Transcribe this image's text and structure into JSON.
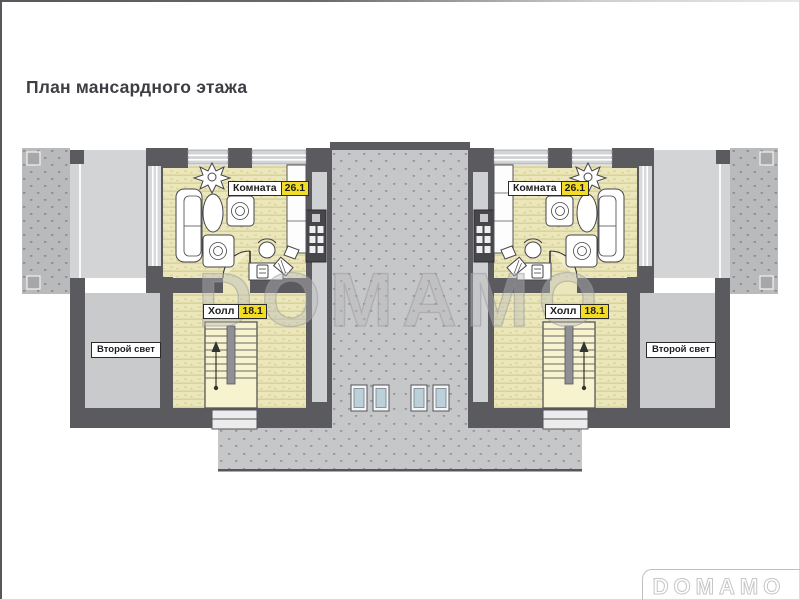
{
  "page_title": "План мансардного этажа",
  "watermark_text": "DOMAMO",
  "logo_text": "DOMAMO",
  "units": [
    {
      "name": "left",
      "room": {
        "label": "Комната",
        "area": "26.1"
      },
      "hall": {
        "label": "Холл",
        "area": "18.1"
      },
      "second_light": {
        "label": "Второй свет"
      }
    },
    {
      "name": "right",
      "room": {
        "label": "Комната",
        "area": "26.1"
      },
      "hall": {
        "label": "Холл",
        "area": "18.1"
      },
      "second_light": {
        "label": "Второй свет"
      }
    }
  ],
  "colors": {
    "wall": "#5a5a5f",
    "room_floor": "#ebe7ba",
    "void_floor": "#c9cacc",
    "roof_light": "#d3d4d6",
    "roof_center": "#c6c7c9",
    "roof_outer": "#b9babc",
    "skylight_glass": "#bcd0da",
    "area_badge": "#f3dc26"
  }
}
